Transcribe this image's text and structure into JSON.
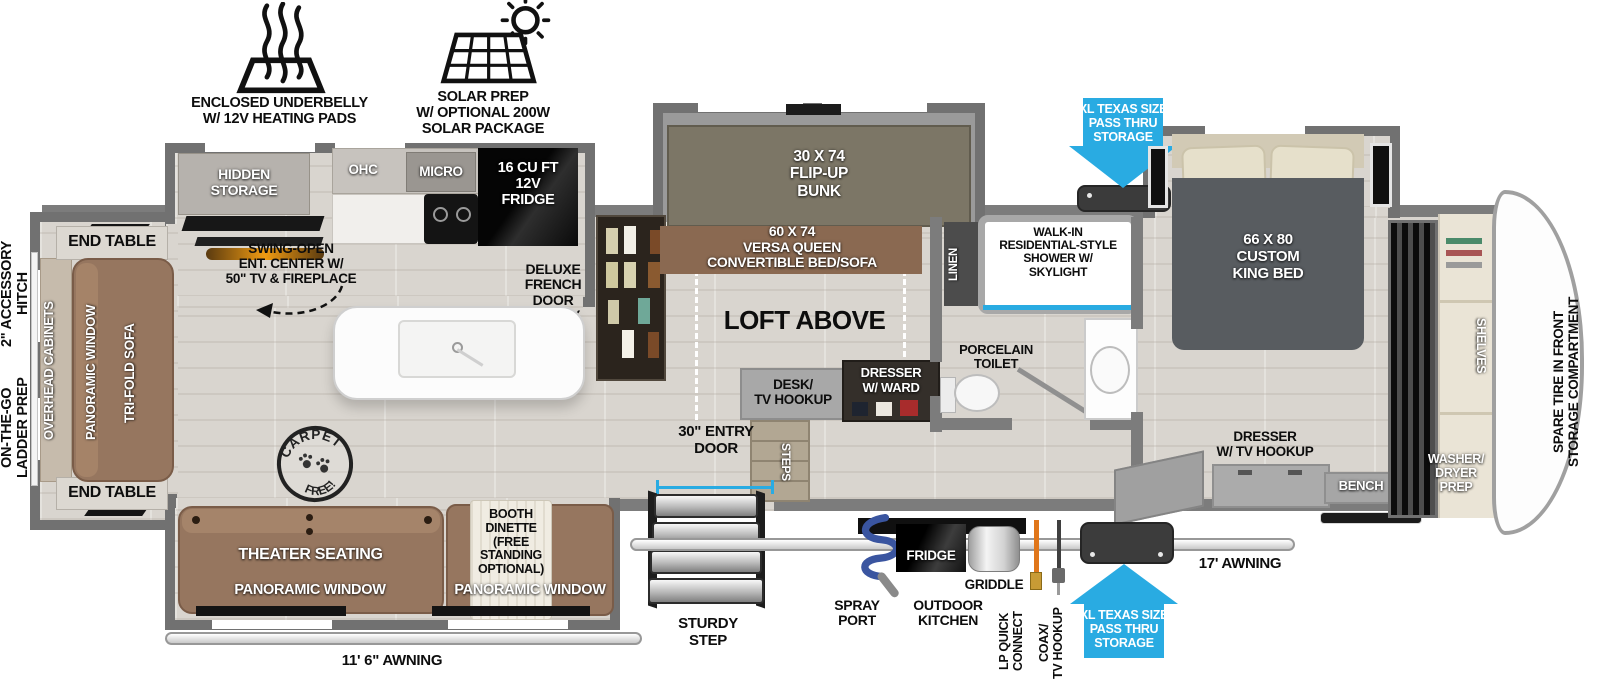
{
  "colors": {
    "accent_blue": "#29abe2",
    "wall_gray": "#7c7c7c",
    "sofa_brown": "#96765f",
    "bed_gray": "#585c60",
    "bunk_olive": "#7c7666",
    "versa_brown": "#8a6951",
    "fireplace_amber": "#ef9b12"
  },
  "icons": {
    "underbelly": "heating-pad-icon",
    "solar": "solar-panel-sun-icon",
    "pass_thru": "blue-arrow",
    "carpet": "round-paw-stamp",
    "spray": "coiled-hose-icon"
  },
  "legend": {
    "underbelly": "ENCLOSED UNDERBELLY\nW/ 12V HEATING PADS",
    "solar": "SOLAR PREP\nW/ OPTIONAL 200W\nSOLAR PACKAGE"
  },
  "exterior": {
    "hitch": "2\" ACCESSORY\nHITCH",
    "ladder": "ON-THE-GO\nLADDER PREP",
    "spare_tire": "SPARE TIRE IN FRONT\nSTORAGE COMPARTMENT",
    "awning_left": "11' 6\" AWNING",
    "awning_right": "17' AWNING",
    "entry_door": "30\" ENTRY\nDOOR",
    "sturdy_step": "STURDY\nSTEP",
    "spray_port": "SPRAY\nPORT",
    "outdoor_kitchen": "OUTDOOR\nKITCHEN",
    "fridge": "FRIDGE",
    "griddle": "GRIDDLE",
    "lp": "LP QUICK\nCONNECT",
    "coax": "COAX/\nTV HOOKUP",
    "pass_thru": "XL TEXAS SIZE\nPASS THRU\nSTORAGE"
  },
  "living": {
    "end_table": "END TABLE",
    "overhead_cabinets": "OVERHEAD CABINETS",
    "panoramic_window": "PANORAMIC WINDOW",
    "trifold": "TRI-FOLD SOFA",
    "theater": "THEATER SEATING",
    "booth": "BOOTH\nDINETTE\n(FREE\nSTANDING\nOPTIONAL)",
    "carpet_top": "CARPET",
    "carpet_bottom": "FREE!"
  },
  "kitchen": {
    "hidden_storage": "HIDDEN\nSTORAGE",
    "ent_center": "SWING-OPEN\nENT. CENTER W/\n50\" TV & FIREPLACE",
    "ohc": "OHC",
    "micro": "MICRO",
    "fridge": "16 CU FT\n12V\nFRIDGE",
    "pantry": "DELUXE\nFRENCH\nDOOR\nPANTRY"
  },
  "loft": {
    "label": "LOFT ABOVE",
    "bunk": "30 X 74\nFLIP-UP\nBUNK",
    "versa": "60 X 74\nVERSA QUEEN\nCONVERTIBLE BED/SOFA",
    "desk": "DESK/\nTV HOOKUP",
    "dresser_ward": "DRESSER\nW/ WARD",
    "steps": "STEPS"
  },
  "bath": {
    "linen": "LINEN",
    "shower": "WALK-IN\nRESIDENTIAL-STYLE\nSHOWER W/\nSKYLIGHT",
    "toilet": "PORCELAIN\nTOILET"
  },
  "bedroom": {
    "king": "66 X 80\nCUSTOM\nKING BED",
    "dresser": "DRESSER\nW/ TV HOOKUP",
    "bench": "BENCH"
  },
  "front": {
    "shelves": "SHELVES",
    "washer_dryer": "WASHER/\nDRYER\nPREP"
  }
}
